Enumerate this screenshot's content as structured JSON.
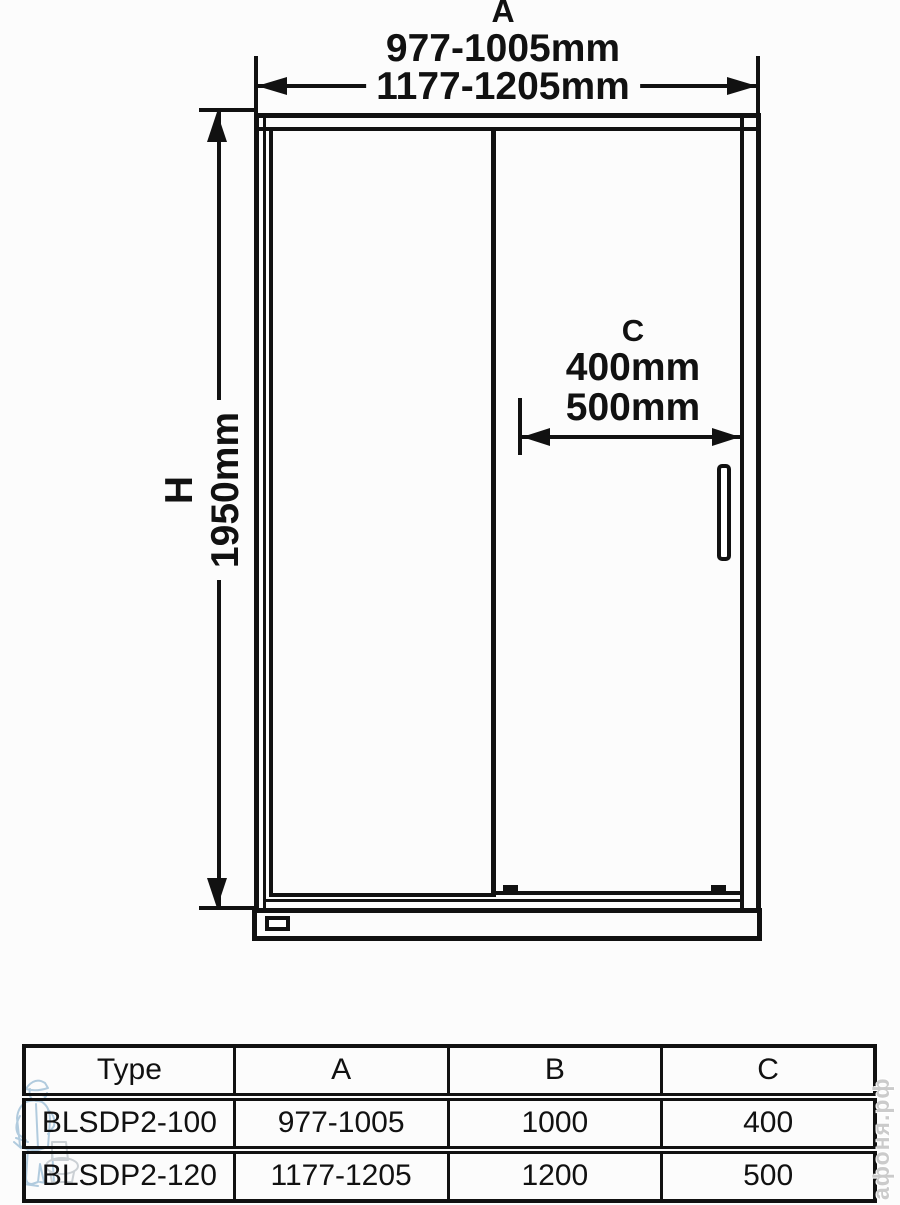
{
  "colors": {
    "background": "#fcfcfc",
    "line": "#111111",
    "mascot_blue": "#a5c3d9",
    "watermark_gray": "#cbcbcb"
  },
  "diagram": {
    "dim_a": {
      "label": "A",
      "range_100": "977-1005mm",
      "range_120": "1177-1205mm"
    },
    "dim_h": {
      "label": "H",
      "value": "1950mm"
    },
    "dim_c": {
      "label": "C",
      "value_100": "400mm",
      "value_120": "500mm"
    }
  },
  "table": {
    "headers": {
      "type": "Type",
      "a": "A",
      "b": "B",
      "c": "C"
    },
    "rows": [
      {
        "type": "BLSDP2-100",
        "a": "977-1005",
        "b": "1000",
        "c": "400"
      },
      {
        "type": "BLSDP2-120",
        "a": "1177-1205",
        "b": "1200",
        "c": "500"
      }
    ]
  },
  "watermark": {
    "site_text": "афоня.рф"
  }
}
